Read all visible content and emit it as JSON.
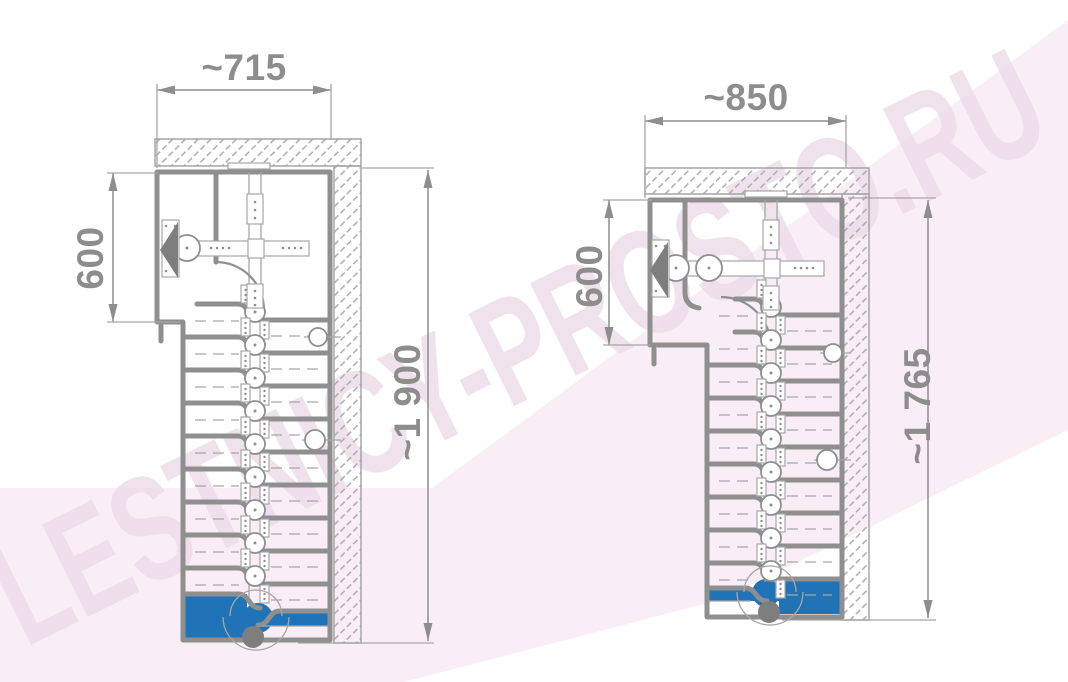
{
  "watermark": "LESTNICY-PROSTO.RU",
  "colors": {
    "line": "#8f8f8f",
    "thin_line": "#a6a6a6",
    "text": "#8d8d8d",
    "dark": "#7e7e7e",
    "accent_blue": "#2173b8",
    "background_pink": "#f9eef5",
    "watermark": "#eeddeb"
  },
  "drawings": [
    {
      "width_label": "~715",
      "landing_depth_label": "600",
      "height_label": "~1 900"
    },
    {
      "width_label": "~850",
      "landing_depth_label": "600",
      "height_label": "~1 765"
    }
  ]
}
